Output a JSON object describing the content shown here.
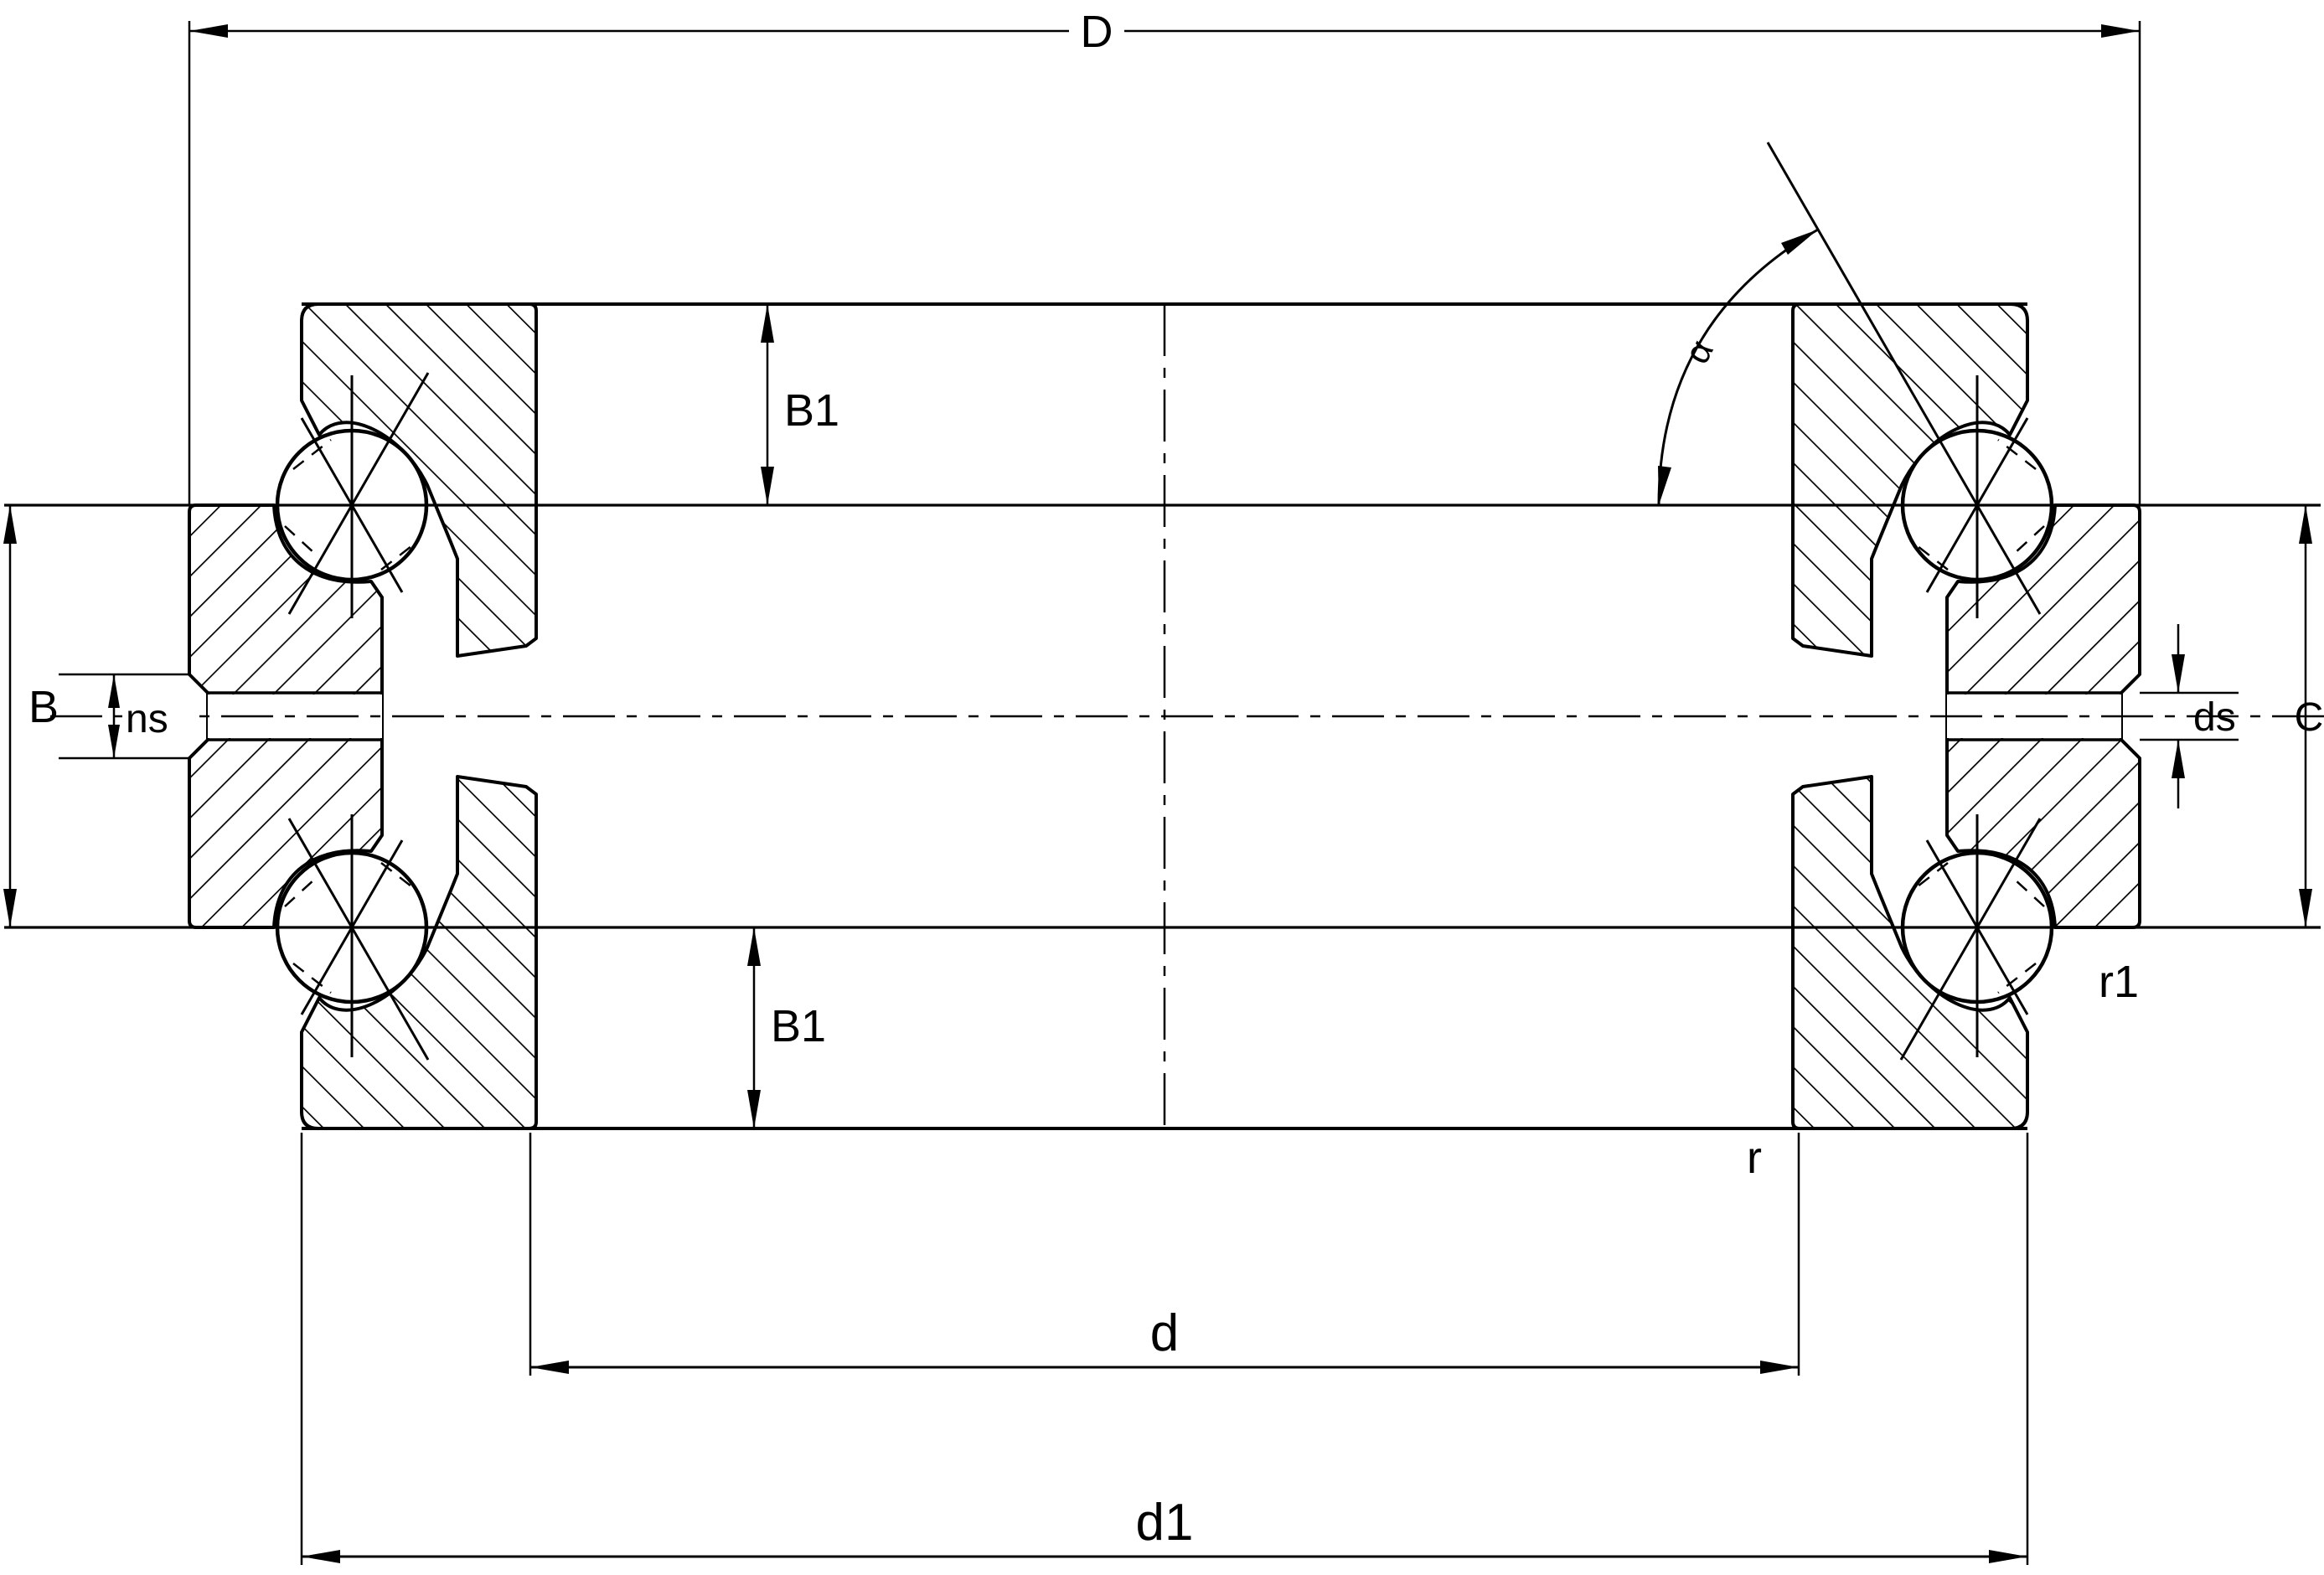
{
  "labels": {
    "outer_diameter": "D",
    "width_top": "B1",
    "contact_angle": "α",
    "width_total": "B",
    "groove_width": "ns",
    "hole_diameter": "ds",
    "housing_washer_height": "C",
    "corner_radius_housing": "r1",
    "width_bottom": "B1",
    "corner_radius_shaft": "r",
    "bore_diameter": "d",
    "shoulder_diameter": "d1"
  },
  "colors": {
    "line": "#000000",
    "background": "#ffffff"
  }
}
